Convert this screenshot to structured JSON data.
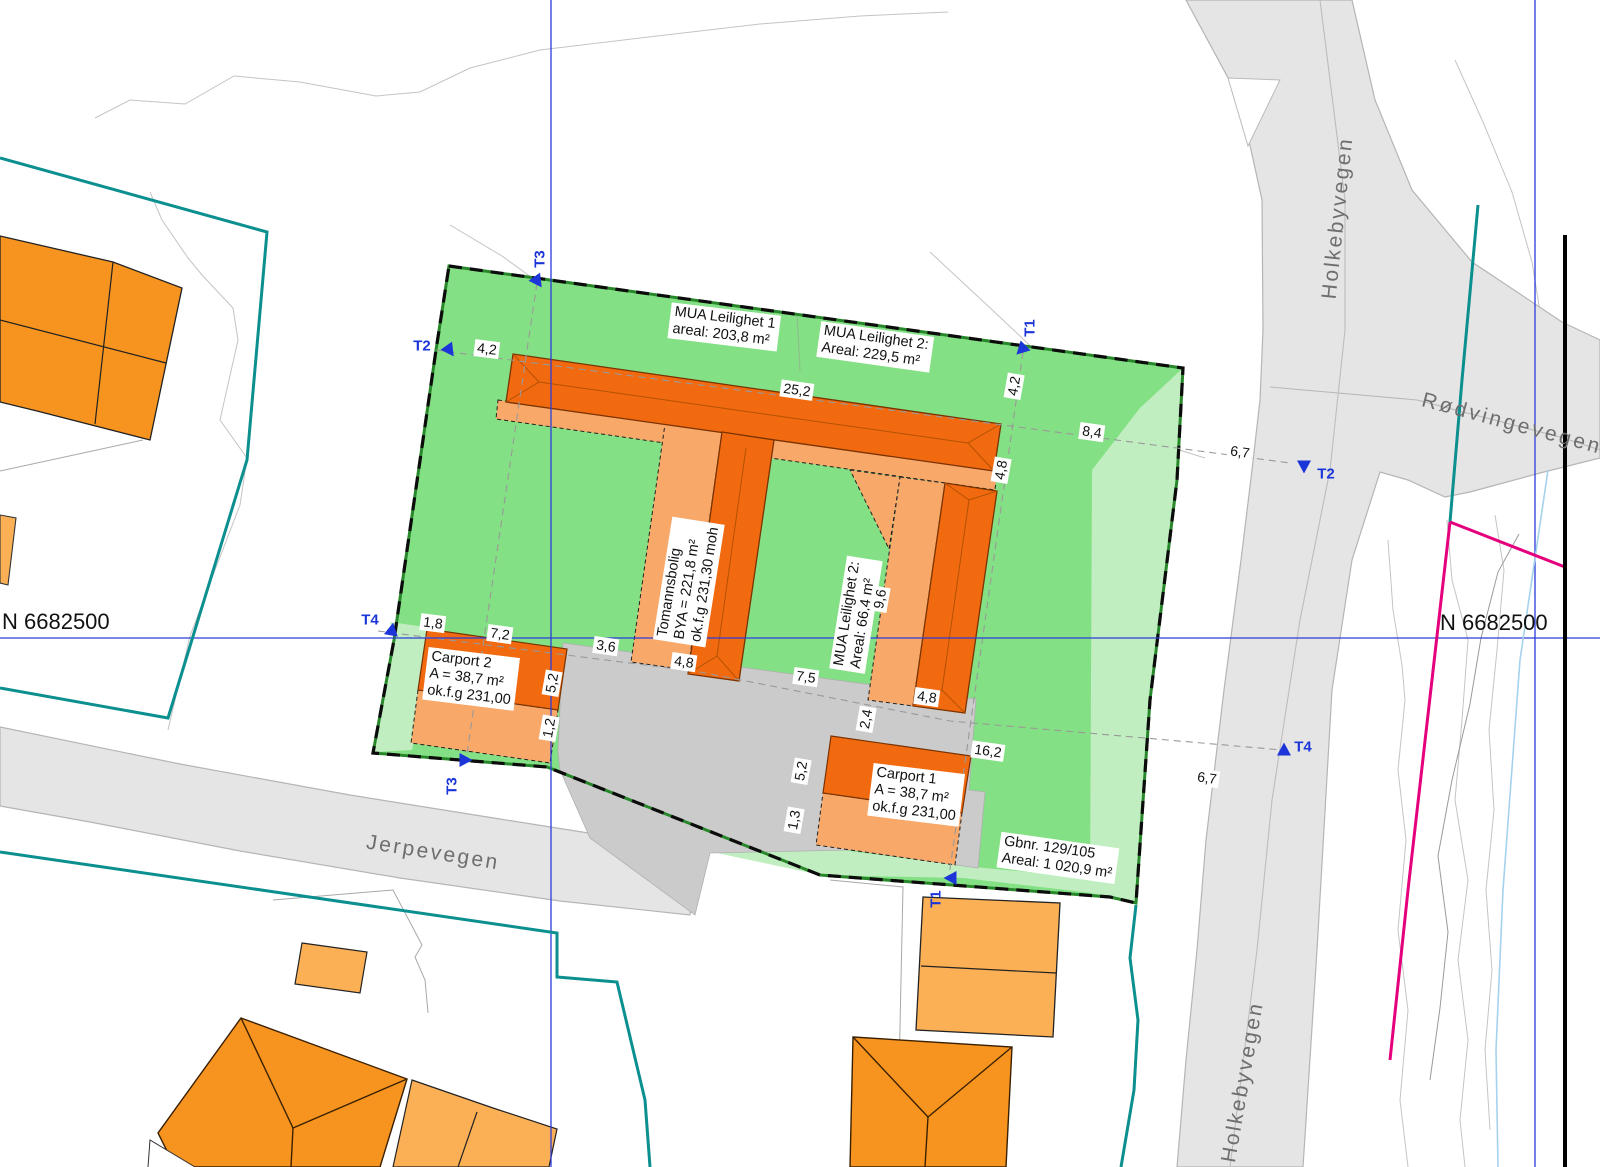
{
  "coordinates": {
    "left": "N 6682500",
    "right": "N 6682500"
  },
  "roads": {
    "jerpevegen": "Jerpevegen",
    "holkebyvegen_top": "Holkebyvegen",
    "holkebyvegen_bottom": "Holkebyvegen",
    "rodvingevegen": "Rødvingevegen"
  },
  "areas": {
    "mua1": {
      "line1": "MUA Leilighet 1",
      "line2": "areal: 203,8 m²"
    },
    "mua2": {
      "line1": "MUA Leilighet 2:",
      "line2": "Areal: 229,5 m²"
    },
    "tomannsbolig": {
      "line1": "Tomannsbolig",
      "line2": "BYA = 221,8 m²",
      "line3": "ok.f.g 231,30 moh"
    },
    "mua2_inner": {
      "line1": "MUA Leilighet 2:",
      "line2": "Areal: 66,4 m²"
    },
    "carport2": {
      "line1": "Carport 2",
      "line2": "A = 38,7 m²",
      "line3": "ok.f.g 231,00"
    },
    "carport1": {
      "line1": "Carport 1",
      "line2": "A = 38,7 m²",
      "line3": "ok.f.g 231,00"
    },
    "parcel": {
      "line1": "Gbnr. 129/105",
      "line2": "Areal: 1 020,9 m²"
    }
  },
  "dims": {
    "d0": "4,2",
    "d1": "25,2",
    "d2": "8,4",
    "d3": "6,7",
    "d4": "4,2",
    "d5": "4,8",
    "d6": "9,6",
    "d7": "4,8",
    "d8": "7,5",
    "d9": "4,8",
    "d10": "2,4",
    "d11": "5,2",
    "d12": "1,2",
    "d13": "7,2",
    "d14": "3,6",
    "d15": "1,8",
    "d16": "5,2",
    "d17": "1,3",
    "d18": "16,2",
    "d19": "6,7"
  },
  "markers": {
    "m0": "T2",
    "m1": "T3",
    "m2": "T1",
    "m3": "T2",
    "m4": "T4",
    "m5": "T4",
    "m6": "T3",
    "m7": "T1"
  },
  "colors": {
    "parcel_green": "#84e084",
    "parcel_green_light": "#c0eec0",
    "building_orange": "#f26a10",
    "roof_orange": "#f8a869",
    "neighbor_orange": "#f79420",
    "neighbor_orange_light": "#fbb055",
    "road_gray": "#e5e5e5",
    "driveway_gray": "#cbcbcb",
    "property_line_teal": "#0b8f8f",
    "boundary_magenta": "#e5007d",
    "survey_marker_blue": "#1b35d8",
    "grid_blue": "#2b3cd9",
    "water_line_blue": "#a5d2ec",
    "boundary_dash_black": "#0c0c0c"
  }
}
